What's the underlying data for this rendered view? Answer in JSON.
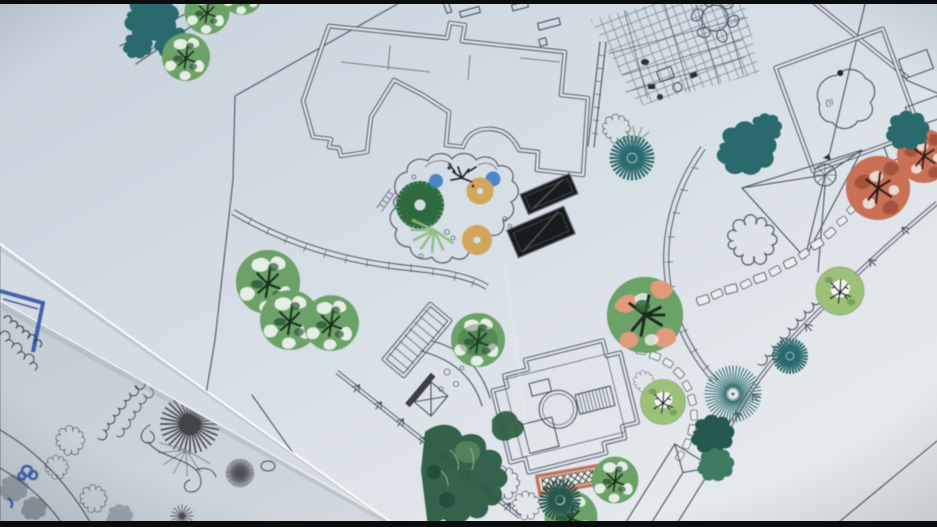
{
  "meta": {
    "scene": "photograph of printed landscape-architecture site plans lying on a table",
    "view": "tilted overhead photo, letterboxed video frame"
  },
  "palette": {
    "bar": "#0b0c0d",
    "paper": "#dae1e8",
    "paperA": "#c8d3dd",
    "paperB": "#d7dfe7",
    "paperC": "#e7ebee",
    "paperWedge": "#d4dbe2",
    "paperUnder": "#cbd3da",
    "line": "#4a5260",
    "ink": "#353b43",
    "gray": "#70787f",
    "grayDark": "#474c52",
    "teal": "#2b6a6d",
    "tealDark": "#27584f",
    "green": "#6ca167",
    "greenDark": "#2c5b41",
    "greenLight": "#9dc179",
    "pink": "#e89a7e",
    "red": "#c96f56",
    "tan": "#d2a75b",
    "blue": "#3f7ec3",
    "blueMarker": "#2d51aa",
    "panel": "#191b1e"
  },
  "sheets": [
    {
      "id": "top",
      "label": "printed master plan sheet"
    },
    {
      "id": "middle",
      "label": "blank corner of sheet below with blue marker lines"
    },
    {
      "id": "bottom",
      "label": "hand-drawn concept sketch sheet"
    }
  ],
  "plan_features": {
    "structures": [
      "house-footprint",
      "pergola-lattice-deck",
      "square-pond-panel",
      "triangle-shade-structure",
      "pavilion-with-round-room",
      "gazebo-hip-roof"
    ],
    "circulation": [
      "curved-walkway",
      "stepped-ramp",
      "ladder-stairs",
      "stepping-stone-trails",
      "boundary-fence",
      "stone-pads"
    ],
    "features": [
      "organic-pond-planting",
      "solar-panels",
      "crosshatch-mat",
      "crossed-post-gate",
      "round-table-with-chairs"
    ]
  },
  "symbol_counts": {
    "green-canopy-trees": 9,
    "green-tree-with-pink-bloom": 1,
    "light-green-line-trees": 2,
    "red-bloom-trees": 2,
    "teal-cloud-shrubs": 7,
    "teal-starburst-plants": 4,
    "tan-starburst-grasses": 2,
    "blue-water-dots": 2,
    "sketch-gray-starbursts": 3
  }
}
